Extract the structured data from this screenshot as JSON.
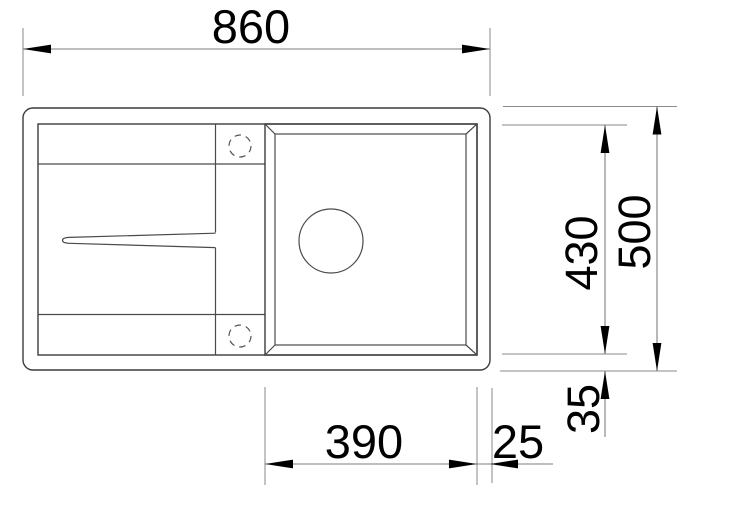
{
  "drawing": {
    "dimensions": {
      "overall_width": "860",
      "overall_depth": "500",
      "inner_depth": "430",
      "bottom_rim_offset": "35",
      "bowl_width": "390",
      "bowl_right_offset": "25"
    },
    "colors": {
      "background": "#ffffff",
      "sink_outline": "#3c3c3c",
      "dimension_lines": "#7d7d7d",
      "arrows_and_text": "#000000"
    }
  }
}
